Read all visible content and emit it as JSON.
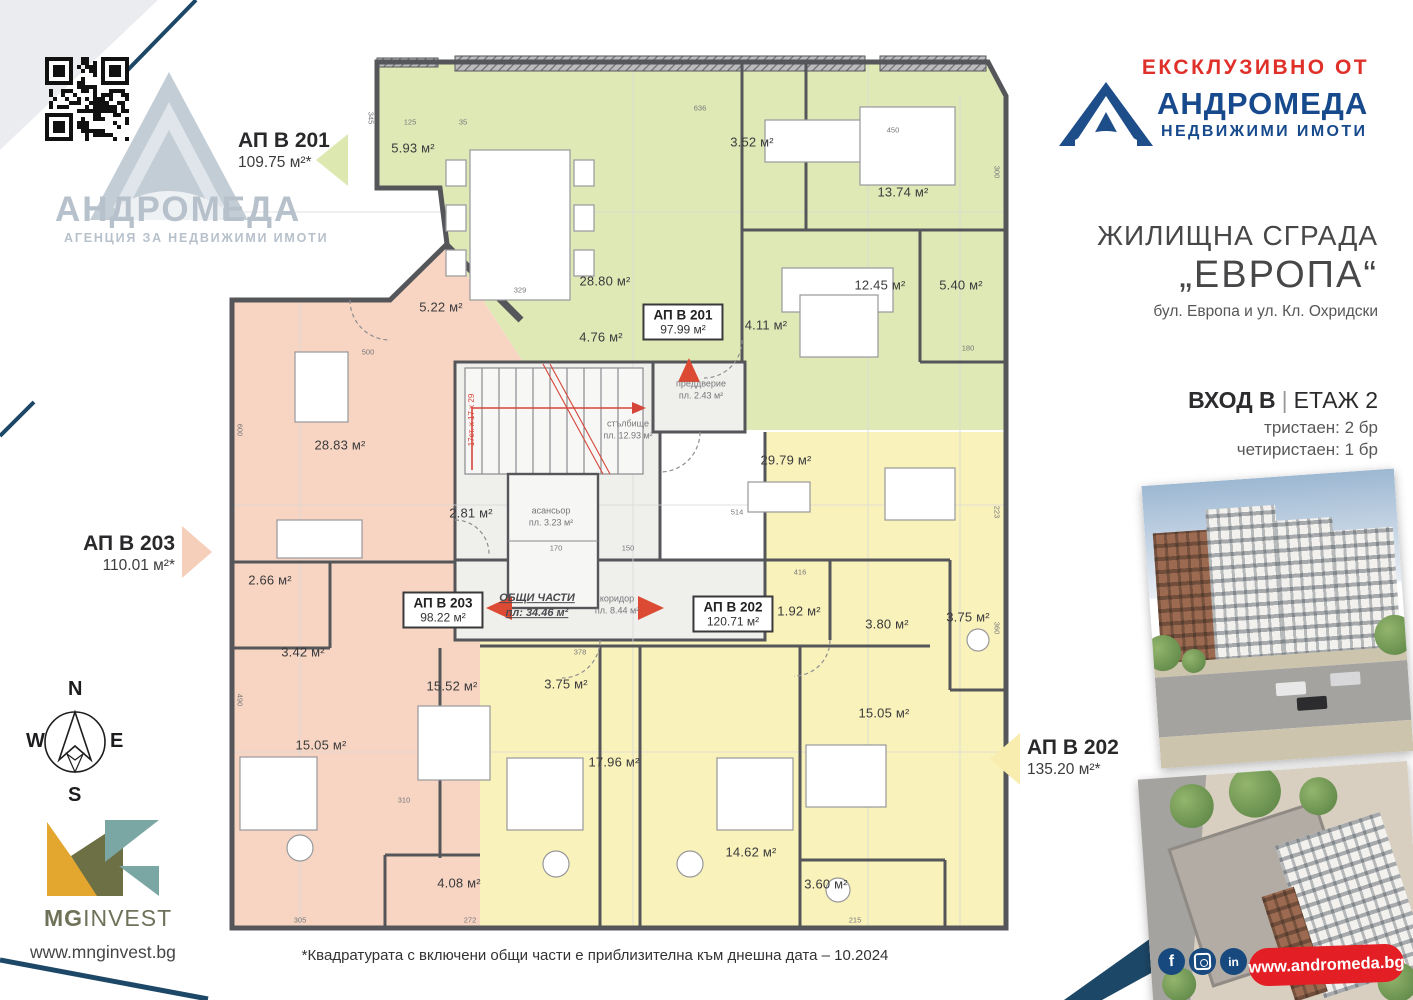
{
  "left_panel": {
    "watermark_name": "АНДРОМЕДА",
    "watermark_tagline": "АГЕНЦИЯ ЗА НЕДВИЖИМИ ИМОТИ",
    "compass": {
      "n": "N",
      "e": "E",
      "s": "S",
      "w": "W"
    },
    "mg_bold": "MG",
    "mg_rest": "INVEST",
    "mg_site": "www.mnginvest.bg"
  },
  "callouts": [
    {
      "name": "АП В 201",
      "area": "109.75 м²*",
      "arrow_color": "#dde8b0"
    },
    {
      "name": "АП В 203",
      "area": "110.01 м²*",
      "arrow_color": "#f6cfba"
    },
    {
      "name": "АП В 202",
      "area": "135.20 м²*",
      "arrow_color": "#f8edaf"
    }
  ],
  "right_panel": {
    "exclusive": "ЕКСКЛУЗИВНО ОТ",
    "brand": "АНДРОМЕДА",
    "brand_sub": "НЕДВИЖИМИ ИМОТИ",
    "building_title": "ЖИЛИЩНА СГРАДА",
    "building_name": "„ЕВРОПА“",
    "address": "бул. Европа и ул. Кл. Охридски",
    "entrance": "ВХОД В",
    "divider": "|",
    "floor": "ЕТАЖ 2",
    "units": [
      "тристаен: 2 бр",
      "четиристаен: 1 бр"
    ],
    "website": "www.andromeda.bg",
    "social": [
      "facebook",
      "instagram",
      "linkedin"
    ],
    "linkedin_glyph": "in",
    "facebook_glyph": "f"
  },
  "footnote": "*Квадратурата с включени общи части е приблизителна към днешна дата – 10.2024",
  "plan": {
    "apartments": [
      {
        "name": "АП В 201",
        "area": "97.99 м²",
        "x": 683,
        "y": 322
      },
      {
        "name": "АП В 203",
        "area": "98.22 м²",
        "x": 443,
        "y": 610
      },
      {
        "name": "АП В 202",
        "area": "120.71 м²",
        "x": 733,
        "y": 614
      }
    ],
    "rooms": [
      {
        "t": "5.93 м²",
        "x": 413,
        "y": 148
      },
      {
        "t": "28.80 м²",
        "x": 605,
        "y": 281
      },
      {
        "t": "3.52 м²",
        "x": 752,
        "y": 142
      },
      {
        "t": "13.74 м²",
        "x": 903,
        "y": 192
      },
      {
        "t": "12.45 м²",
        "x": 880,
        "y": 285
      },
      {
        "t": "5.40 м²",
        "x": 961,
        "y": 285
      },
      {
        "t": "4.11 м²",
        "x": 766,
        "y": 325
      },
      {
        "t": "4.76 м²",
        "x": 601,
        "y": 337
      },
      {
        "t": "5.22 м²",
        "x": 441,
        "y": 307
      },
      {
        "t": "28.83 м²",
        "x": 340,
        "y": 445
      },
      {
        "t": "2.81 м²",
        "x": 471,
        "y": 513
      },
      {
        "t": "2.66 м²",
        "x": 270,
        "y": 580
      },
      {
        "t": "3.42 м²",
        "x": 303,
        "y": 652
      },
      {
        "t": "15.52 м²",
        "x": 452,
        "y": 686
      },
      {
        "t": "15.05 м²",
        "x": 321,
        "y": 745
      },
      {
        "t": "4.08 м²",
        "x": 459,
        "y": 883
      },
      {
        "t": "29.79 м²",
        "x": 786,
        "y": 460
      },
      {
        "t": "1.92 м²",
        "x": 799,
        "y": 611
      },
      {
        "t": "3.80 м²",
        "x": 887,
        "y": 624
      },
      {
        "t": "3.75 м²",
        "x": 968,
        "y": 617
      },
      {
        "t": "15.05 м²",
        "x": 884,
        "y": 713
      },
      {
        "t": "3.75 м²",
        "x": 566,
        "y": 684
      },
      {
        "t": "17.96 м²",
        "x": 614,
        "y": 762
      },
      {
        "t": "14.62 м²",
        "x": 751,
        "y": 852
      },
      {
        "t": "3.60 м²",
        "x": 826,
        "y": 884
      }
    ],
    "common": [
      {
        "l1": "преддверие",
        "l2": "пл. 2.43 м²",
        "x": 701,
        "y": 390
      },
      {
        "l1": "стълбище",
        "l2": "пл. 12.93 м²",
        "x": 628,
        "y": 430
      },
      {
        "l1": "асансьор",
        "l2": "пл. 3.23 м²",
        "x": 551,
        "y": 517
      },
      {
        "l1": "коридор",
        "l2": "пл. 8.44 м²",
        "x": 617,
        "y": 605
      },
      {
        "l1": "17ст. х 17 х 29",
        "l2": "",
        "x": 472,
        "y": 420,
        "r": -90,
        "red": true
      }
    ],
    "common_total": {
      "l1": "ОБЩИ ЧАСТИ",
      "l2": "пл:  34.46 м²",
      "x": 537,
      "y": 606
    },
    "dims": [
      {
        "t": "125",
        "x": 410,
        "y": 122
      },
      {
        "t": "35",
        "x": 463,
        "y": 122
      },
      {
        "t": "636",
        "x": 700,
        "y": 108
      },
      {
        "t": "450",
        "x": 893,
        "y": 130
      },
      {
        "t": "514",
        "x": 737,
        "y": 512
      },
      {
        "t": "329",
        "x": 520,
        "y": 290
      },
      {
        "t": "500",
        "x": 368,
        "y": 352
      },
      {
        "t": "345",
        "x": 371,
        "y": 118,
        "r": 90
      },
      {
        "t": "600",
        "x": 240,
        "y": 430,
        "r": 90
      },
      {
        "t": "490",
        "x": 240,
        "y": 700,
        "r": 90
      },
      {
        "t": "300",
        "x": 997,
        "y": 172,
        "r": 90
      },
      {
        "t": "360",
        "x": 997,
        "y": 628,
        "r": 90
      },
      {
        "t": "223",
        "x": 997,
        "y": 512,
        "r": 90
      },
      {
        "t": "272",
        "x": 470,
        "y": 920
      },
      {
        "t": "215",
        "x": 855,
        "y": 920
      },
      {
        "t": "305",
        "x": 300,
        "y": 920
      },
      {
        "t": "378",
        "x": 580,
        "y": 652
      },
      {
        "t": "150",
        "x": 628,
        "y": 548
      },
      {
        "t": "170",
        "x": 556,
        "y": 548
      },
      {
        "t": "416",
        "x": 800,
        "y": 572
      },
      {
        "t": "180",
        "x": 968,
        "y": 348
      },
      {
        "t": "310",
        "x": 404,
        "y": 800
      }
    ]
  }
}
